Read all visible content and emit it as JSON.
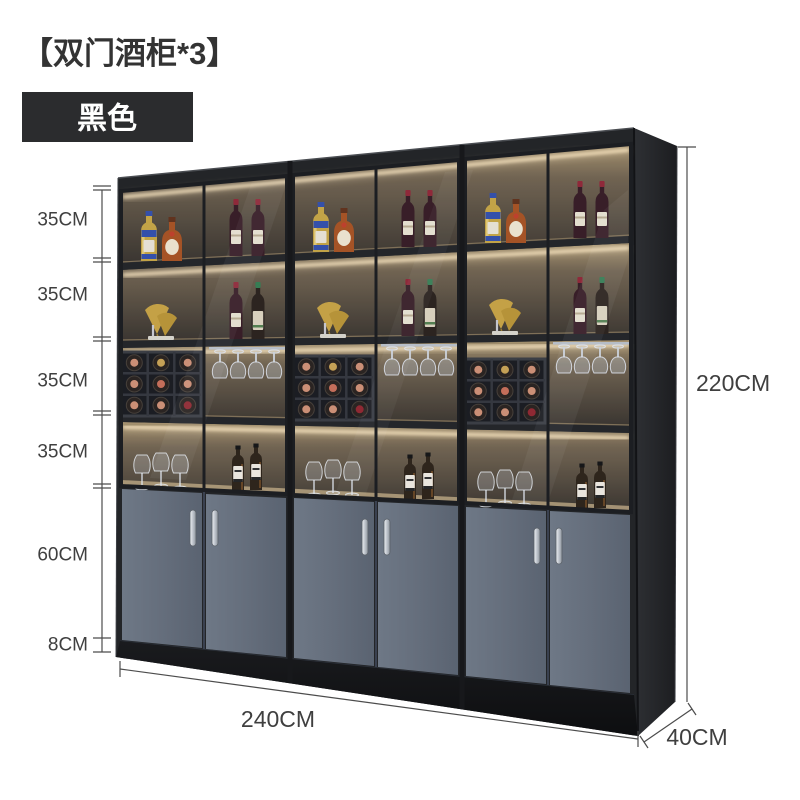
{
  "page": {
    "background_color": "#ffffff"
  },
  "product": {
    "title": "【双门酒柜*3】",
    "variant": {
      "label": "黑色",
      "badge_bg": "#2b2c2e",
      "badge_text_color": "#ffffff"
    }
  },
  "dimensions": {
    "unit_heights": [
      "35CM",
      "35CM",
      "35CM",
      "35CM",
      "60CM",
      "8CM"
    ],
    "total_height": "220CM",
    "total_width": "240CM",
    "depth": "40CM"
  },
  "cabinet": {
    "unit_count": 3,
    "doors_per_unit": 2,
    "style": {
      "frame_color": "#232528",
      "door_color": "#636c7a",
      "interior_glow_color": "#ffe9c0",
      "plinth_color": "#141517",
      "handle_color": "#d7dbe0"
    },
    "shelf_contents": {
      "row1": [
        "whisky-bottle",
        "cognac-bottle",
        "red-wine-bottle",
        "red-wine-bottle"
      ],
      "row2": [
        "ginkgo-decor",
        "red-wine-bottle",
        "green-wine-bottle"
      ],
      "row3": [
        "wine-rack-3x3",
        "hanging-stemware"
      ],
      "row4": [
        "wine-glasses",
        "whisky-bottles"
      ]
    }
  }
}
